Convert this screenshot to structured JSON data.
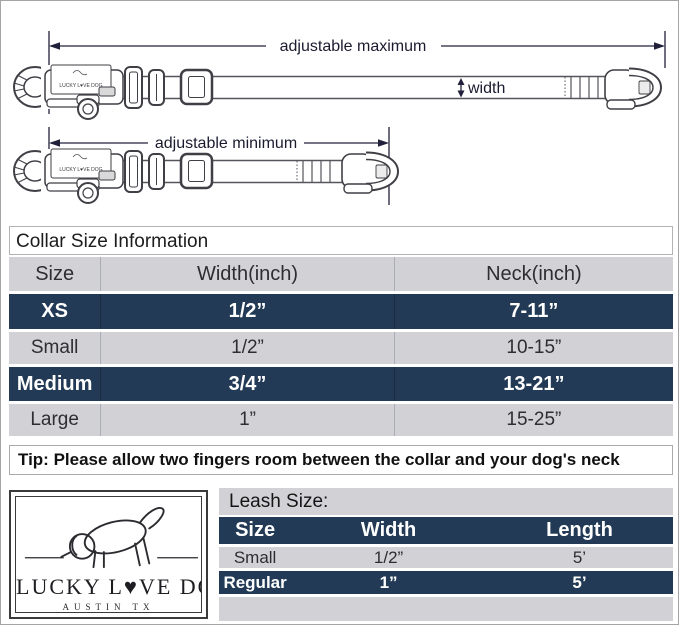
{
  "diagram": {
    "adjustable_maximum": "adjustable maximum",
    "adjustable_minimum": "adjustable minimum",
    "width_label": "width",
    "collar_tag_text": "LUCKY L♥VE DOG"
  },
  "collar_table": {
    "title": "Collar Size Information",
    "headers": [
      "Size",
      "Width(inch)",
      "Neck(inch)"
    ],
    "rows": [
      {
        "size": "XS",
        "width": "1/2”",
        "neck": "7-11”"
      },
      {
        "size": "Small",
        "width": "1/2”",
        "neck": "10-15”"
      },
      {
        "size": "Medium",
        "width": "3/4”",
        "neck": "13-21”"
      },
      {
        "size": "Large",
        "width": "1”",
        "neck": "15-25”"
      }
    ],
    "tip": "Tip: Please allow two fingers room between the collar and your dog's neck"
  },
  "logo": {
    "brand": "LUCKY L♥VE DOG",
    "location": "AUSTIN TX"
  },
  "leash_table": {
    "title": "Leash Size:",
    "headers": [
      "Size",
      "Width",
      "Length"
    ],
    "rows": [
      {
        "size": "Small",
        "width": "1/2”",
        "length": "5’"
      },
      {
        "size": "Regular",
        "width": "1”",
        "length": "5’"
      }
    ]
  },
  "colors": {
    "navy": "#223a55",
    "row_gray": "#d2d2d6",
    "dimension_line": "#20203a"
  }
}
